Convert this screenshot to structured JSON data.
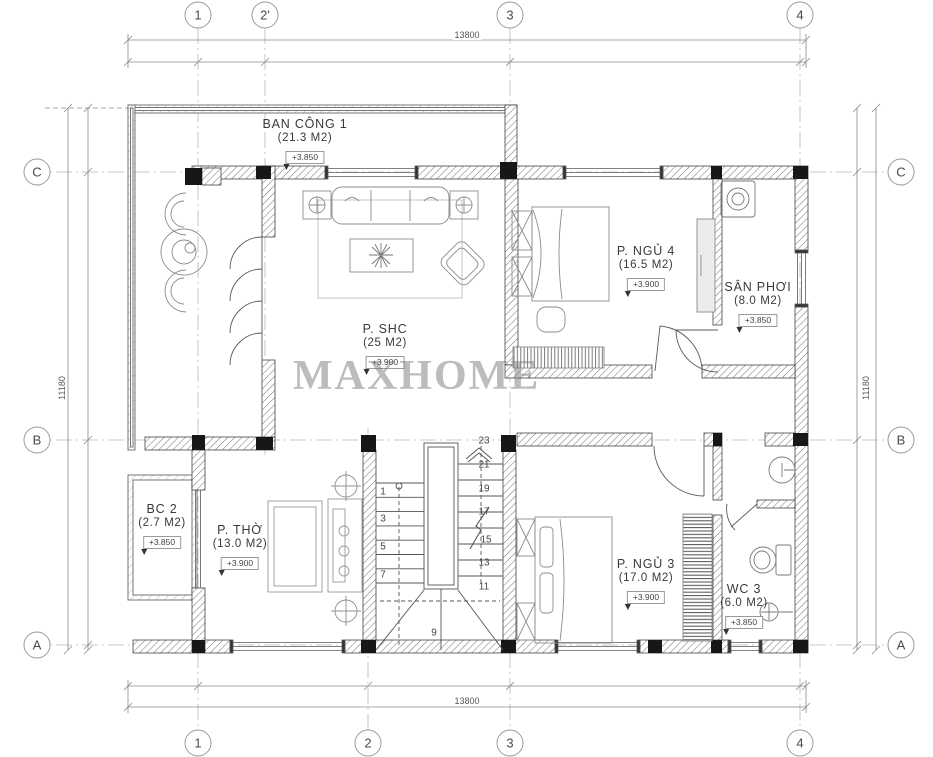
{
  "watermark": "MAXHOME",
  "grid": {
    "top": [
      "1",
      "2'",
      "3",
      "4"
    ],
    "bottom": [
      "1",
      "2",
      "3",
      "4"
    ],
    "left": [
      "C",
      "B",
      "A"
    ],
    "right": [
      "C",
      "B",
      "A"
    ]
  },
  "dimensions": {
    "width_top": "13800",
    "width_bottom": "13800",
    "height_left": "11180",
    "height_right": "11180"
  },
  "rooms": [
    {
      "name": "BAN CÔNG 1",
      "area": "(21.3 M2)",
      "level": "+3.850"
    },
    {
      "name": "P. SHC",
      "area": "(25 M2)",
      "level": "+3.900"
    },
    {
      "name": "P. NGỦ 4",
      "area": "(16.5 M2)",
      "level": "+3.900"
    },
    {
      "name": "SÂN PHƠI",
      "area": "(8.0 M2)",
      "level": "+3.850"
    },
    {
      "name": "BC 2",
      "area": "(2.7 M2)",
      "level": "+3.850"
    },
    {
      "name": "P. THỜ",
      "area": "(13.0 M2)",
      "level": "+3.900"
    },
    {
      "name": "P. NGỦ 3",
      "area": "(17.0 M2)",
      "level": "+3.900"
    },
    {
      "name": "WC 3",
      "area": "(6.0 M2)",
      "level": "+3.850"
    }
  ],
  "stairs": {
    "left_steps": [
      "1",
      "3",
      "5",
      "7"
    ],
    "right_steps": [
      "23",
      "21",
      "19",
      "17",
      "15",
      "13",
      "11"
    ],
    "bottom_step": "9"
  },
  "symbols": {
    "stair_direction_arrow": "chevron-up-icon",
    "level_marker": "triangle-down-icon",
    "column_marker": "crossed-circle-icon"
  },
  "colors": {
    "wall_fill": "#1a1a1a",
    "hatch": "#777777",
    "line": "#555555",
    "grid_line": "#b8b8b8",
    "text": "#3a3a3a",
    "watermark": "#7a7a7a"
  }
}
